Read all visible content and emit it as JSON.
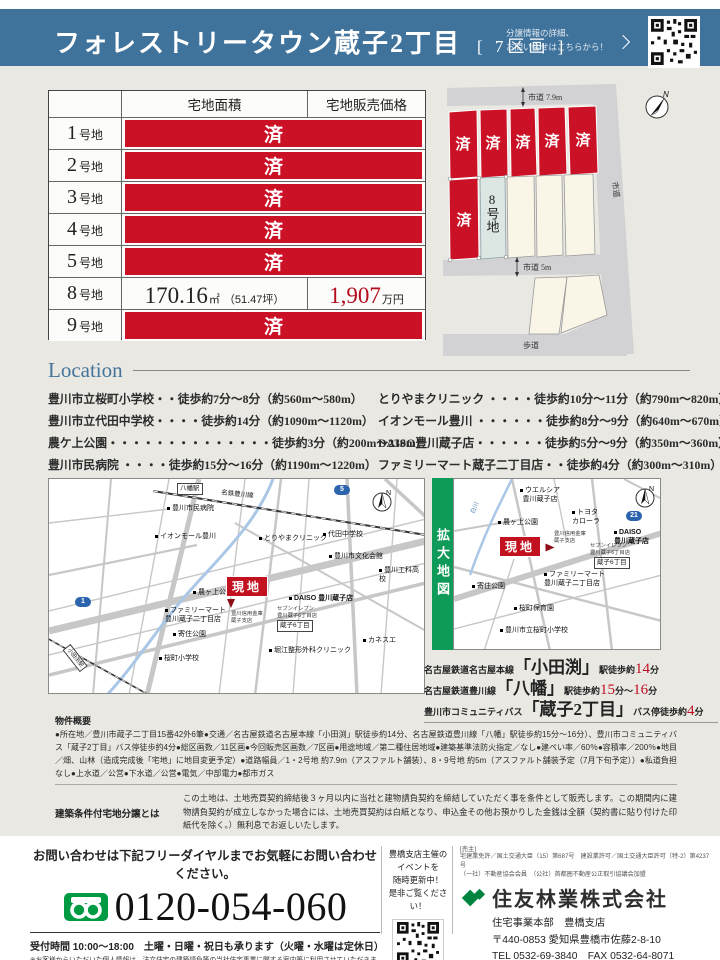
{
  "colors": {
    "header_blue": "#40739c",
    "sold_red": "#cb1126",
    "price_red": "#b30d1d",
    "zoom_green": "#0e9a58",
    "brand_green": "#008a43"
  },
  "common": {
    "n": "N"
  },
  "header": {
    "title": "フォレストリータウン蔵子2丁目",
    "subtitle": "[ 7区画 ]",
    "qr_note": "分譲情報の詳細、\nお問い合せはこちらから！"
  },
  "table": {
    "headers": [
      "宅地面積",
      "宅地販売価格"
    ],
    "rows": [
      {
        "num": "1",
        "suffix": "号地",
        "status": "済"
      },
      {
        "num": "2",
        "suffix": "号地",
        "status": "済"
      },
      {
        "num": "3",
        "suffix": "号地",
        "status": "済"
      },
      {
        "num": "4",
        "suffix": "号地",
        "status": "済"
      },
      {
        "num": "5",
        "suffix": "号地",
        "status": "済"
      },
      {
        "num": "8",
        "suffix": "号地",
        "area_main": "170.16",
        "area_unit": "㎡",
        "area_tsubo": "（51.47坪）",
        "price_main": "1,907",
        "price_unit": "万円"
      },
      {
        "num": "9",
        "suffix": "号地",
        "status": "済"
      }
    ]
  },
  "siteplan": {
    "sold": "済",
    "lot8": "8号地",
    "road_top": "市道 7.9m",
    "road_right": "市道",
    "road_mid": "市道 5m",
    "road_bottom": "歩道"
  },
  "location": {
    "heading": "Location",
    "left": [
      "豊川市立桜町小学校・・徒歩約7分～8分（約560m～580m）",
      "豊川市立代田中学校・・・・徒歩約14分（約1090m～1120m）",
      "農ケ上公園・・・・・・・・・・・・・・徒歩約3分（約200m～230m）",
      "豊川市民病院 ・・・・徒歩約15分～16分（約1190m～1220m）"
    ],
    "right": [
      "とりやまクリニック ・・・・徒歩約10分～11分（約790m～820m）",
      "イオンモール豊川 ・・・・・・徒歩約8分～9分（約640m～670m）",
      "DAISO豊川蔵子店・・・・・・徒歩約5分～9分（約350m～360m）",
      "ファミリーマート蔵子二丁目店・・徒歩約4分（約300m～310m）"
    ]
  },
  "maps": {
    "site_label": "現地",
    "left": {
      "yawata_station": "八幡駅",
      "rail": "名鉄豊川線",
      "hospital": "豊川市民病院",
      "route5": "5",
      "aeon": "イオンモール豊川",
      "clinic": "とりやまクリニック",
      "daida_jhs": "代田中学校",
      "bunka": "豊川市文化会館",
      "kouka_hs": "豊川工科高校",
      "nogaue_park": "農ヶ上公園",
      "daiso": "DAISO 豊川蔵子店",
      "seven": "セブンイレブン\n豊川蔵子6丁目店",
      "kurako6": "蔵子6丁目",
      "shinkin": "豊川信用金庫\n蔵子支店",
      "famima": "ファミリーマート\n豊川蔵子二丁目店",
      "route1": "1",
      "yorizumi_park": "寄住公園",
      "sakura_es": "桜町小学校",
      "horie_clinic": "堀江整形外科クリニック",
      "kanesue": "カネスエ",
      "odabuchi_station": "小田渕駅"
    },
    "right": {
      "zoom_label": "拡大地図",
      "welcia": "ウエルシア\n豊川蔵子店",
      "river": "白川",
      "nogaue_park": "農ヶ上公園",
      "toyota": "トヨタ\nカローラ",
      "route21": "21",
      "daiso": "DAISO\n豊川蔵子店",
      "shinkin": "豊川信用金庫\n蔵子支店",
      "seven": "セブンイレブン\n豊川蔵子6丁目店",
      "kurako6": "蔵子6丁目",
      "famima": "ファミリーマート\n豊川蔵子二丁目店",
      "yorizumi_park": "寄住公園",
      "hoikuen": "桜町保育園",
      "sakura_es": "豊川市立桜町小学校"
    }
  },
  "access": {
    "lines": [
      {
        "pre": "名古屋鉄道名古屋本線",
        "name": "「小田渕」",
        "type": "駅",
        "walk": " 徒歩約",
        "n1": "14",
        "u1": "分"
      },
      {
        "pre": "名古屋鉄道豊川線",
        "name": "「八幡」",
        "type": "駅",
        "walk": " 徒歩約",
        "n1": "15",
        "u1": "分～",
        "n2": "16",
        "u2": "分"
      },
      {
        "pre": "豊川市コミュニティバス",
        "name": "「蔵子2丁目」",
        "type": "バス停",
        "walk": " 徒歩約",
        "n1": "4",
        "u1": "分"
      }
    ]
  },
  "overview": {
    "heading": "物件概要",
    "body": "●所在地／豊川市蔵子二丁目15番42外6筆●交通／名古屋鉄道名古屋本線「小田渕」駅徒歩約14分、名古屋鉄道豊川線「八幡」駅徒歩約15分～16分）、豊川市コミュニティバス「蔵子2丁目」バス停徒歩約4分●総区画数／11区画●今回販売区画数／7区画●用途地域／第二種住居地域●建築基準法防火指定／なし●建ぺい率／60％●容積率／200％●地目／畑、山林（造成完成後「宅地」に地目変更予定）●道路幅員／1・2号地 約7.9m（アスファルト舗装）、8・9号地 約5m（アスファルト舗装予定（7月下旬予定））●私道負担なし●上水道／公営●下水道／公営●電気／中部電力●都市ガス"
  },
  "conditions": {
    "label": "建築条件付宅地分譲とは",
    "body": "この土地は、土地売買契約締結後３ヶ月以内に当社と建物請負契約を締結していただく事を条件として販売します。この期間内に建物請負契約が成立しなかった場合には、土地売買契約は白紙となり、申込金その他お預かりした金銭は全額（契約書に貼り付けた印紙代を除く。）無利息でお返しいたします。"
  },
  "footer": {
    "inquiry": "お問い合わせは下記フリーダイヤルまでお気軽にお問い合わせください。",
    "phone": "0120-054-060",
    "hours": "受付時間 10:00～18:00　土曜・日曜・祝日も承ります（火曜・水曜は定休日）",
    "privacy": "※お客様からいただいた個人情報は、注文住宅の建築請負等の当社住宅事業に関する案内等に利用させていただきます。\n　詳細は当社ホームページ（https://sfc.jp/hogo/）をご参照ください。",
    "event": "豊橋支店主催の\nイベントを\n随時更新中！\n是非ご覧ください！",
    "seller_tag": "[売主]",
    "license1": "宅建業免許／国土交通大臣（15）第687号　建設業許可／国土交通大臣許可（特-2）第4237号",
    "license2": "（一社）不動産協会会員　（公社）首都圏不動産公正取引協議会加盟",
    "company": "住友林業株式会社",
    "division": "住宅事業本部　豊橋支店",
    "address": "〒440-0853 愛知県豊橋市佐藤2-8-10",
    "tel": "TEL 0532-69-3840　FAX 0532-64-8071",
    "url": "https://sfc.jp/ie/"
  }
}
